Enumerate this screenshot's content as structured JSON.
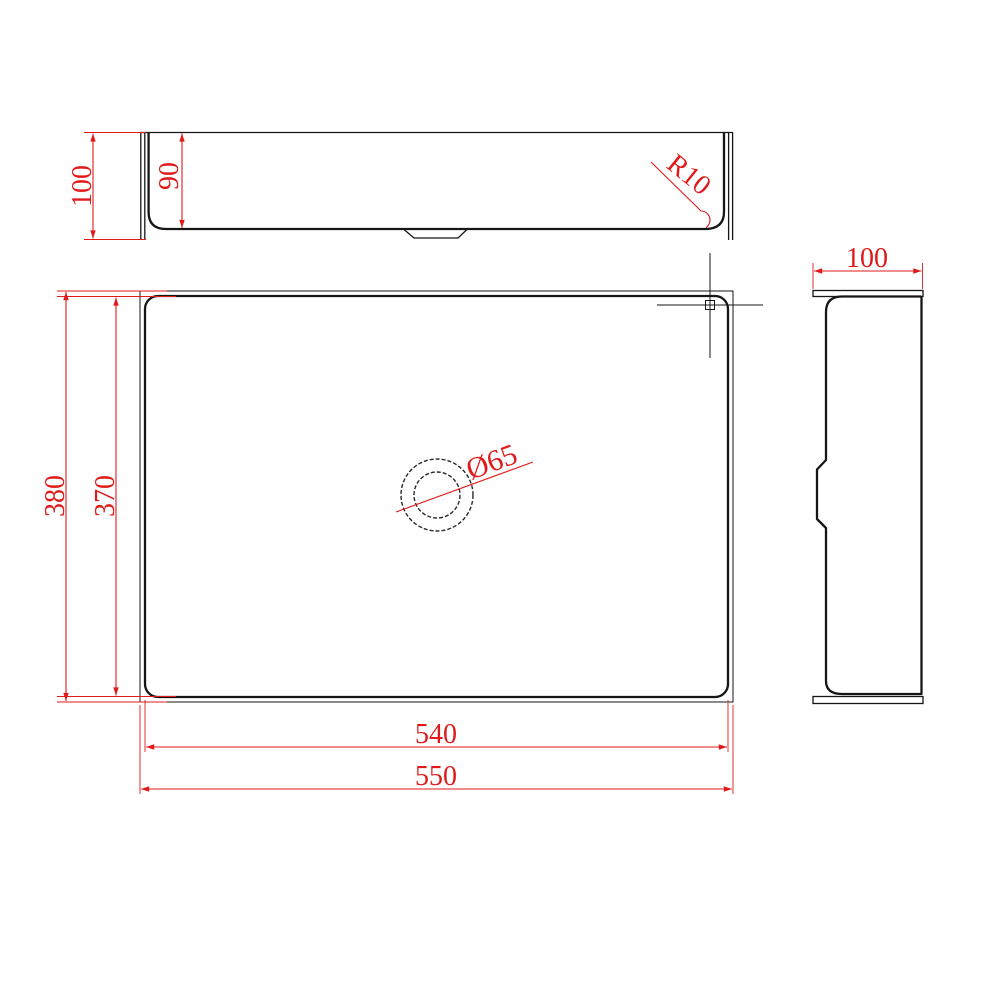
{
  "drawing": {
    "title": "rectangular-basin-orthographic-views",
    "views": [
      "front-elevation",
      "plan",
      "side-elevation"
    ]
  },
  "labels": {
    "front_total_height": "100",
    "front_inner_depth": "90",
    "corner_radius": "R10",
    "plan_outer_depth": "380",
    "plan_inner_depth": "370",
    "plan_inner_width": "540",
    "plan_outer_width": "550",
    "drain_diameter": "Ø65",
    "side_total_width": "100"
  },
  "colors": {
    "dimension": "#e01a1a",
    "line": "#161616",
    "background": "#ffffff"
  }
}
